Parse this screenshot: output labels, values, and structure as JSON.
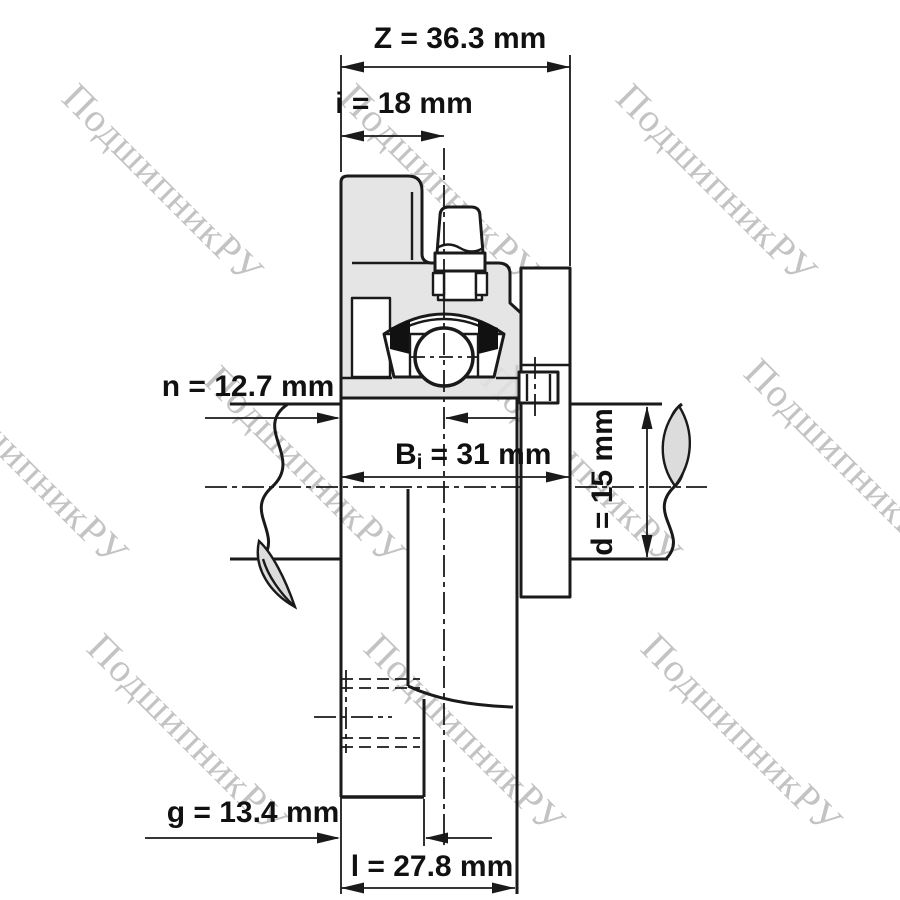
{
  "watermark": {
    "text": "ПодшипникРУ"
  },
  "colors": {
    "line": "#1a1a1a",
    "housing_fill": "#e2e2e2",
    "watermark": "#c3c3c3",
    "background": "#ffffff"
  },
  "dimensions": {
    "z": "Z = 36.3 mm",
    "i": "i = 18 mm",
    "n": "n = 12.7 mm",
    "bi_base": "B",
    "bi_sub": "i",
    "bi_value": "= 31 mm",
    "d": "d = 15 mm",
    "g": "g = 13.4 mm",
    "l": "l = 27.8 mm"
  }
}
